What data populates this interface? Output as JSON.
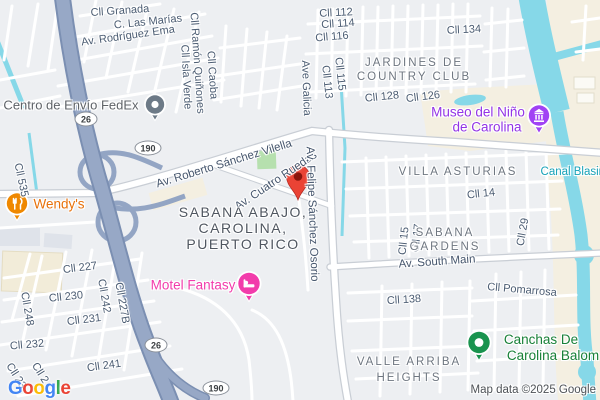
{
  "labels": {
    "streets": {
      "granada": "Cll Granada",
      "las_marias": "C. Las Marías",
      "rodriguez_ema": "Av. Rodríguez Ema",
      "ramon_quinones": "Cll Ramón Quiñones",
      "isla_verde": "Cll Isla Verde",
      "caoba": "Cll Caoba",
      "cll112": "Cll 112",
      "cll114": "Cll 114",
      "cll116": "Cll 116",
      "cll134": "Cll 134",
      "ave_galicia": "Ave Galicia",
      "cll115": "Cll 115",
      "cll113": "Cll 113",
      "cll128": "Cll 128",
      "cll126": "Cll 126",
      "vilella": "Av. Roberto Sánchez Vilella",
      "cuatro_ruedas": "Av. Cuatro Ruedas",
      "osorio": "Av. Felipe Sánchez Osorio",
      "cll535": "Cll 535",
      "cll14": "Cll 14",
      "cll15": "Cll 15",
      "cll17": "Cll 17",
      "cll29": "Cll 29",
      "south_main": "Av. South Main",
      "cll227": "Cll 227",
      "cll230": "Cll 230",
      "cll248": "Cll 248",
      "cll242": "Cll 242",
      "cll227b": "Cll 227B",
      "cll231": "Cll 231",
      "cll232": "Cll 232",
      "cll241": "Cll 241",
      "cll138": "Cll 138",
      "pomarrosa": "Cll Pomarrosa",
      "cll23_a": "Cll 23",
      "cll23_b": "Cll 2"
    },
    "areas": {
      "jardines_1": "JARDINES DE",
      "jardines_2": "COUNTRY CLUB",
      "villa_asturias": "VILLA ASTURIAS",
      "sabana_gardens_1": "SABANA",
      "sabana_gardens_2": "GARDENS",
      "sabana_abajo_1": "SABANA ABAJO,",
      "sabana_abajo_2": "CAROLINA,",
      "sabana_abajo_3": "PUERTO RICO",
      "valle_arriba_1": "VALLE ARRIBA",
      "valle_arriba_2": "HEIGHTS"
    },
    "water": {
      "canal_blasina": "Canal Blasina"
    }
  },
  "pois": {
    "fedex": {
      "label": "Centro de Envío FedEx",
      "icon": "generic-poi-pin",
      "color": "#6d7a87"
    },
    "wendys": {
      "label": "Wendy's",
      "icon": "restaurant-pin",
      "color": "#ef8800"
    },
    "motel": {
      "label": "Motel Fantasy",
      "icon": "hotel-bed-pin",
      "color": "#f23cab"
    },
    "museo": {
      "line1": "Museo del Niño",
      "line2": "de Carolina",
      "icon": "museum-pin",
      "color": "#a142f4"
    },
    "canchas": {
      "line1": "Canchas De",
      "line2": "Carolina Balom",
      "icon": "sports-field-pin",
      "color": "#19934e"
    }
  },
  "badges": {
    "pr26": "26",
    "pr190": "190"
  },
  "marker": {
    "type": "destination-pin",
    "color": "#EA4335"
  },
  "footer": {
    "attribution": "Map data ©2025 Google",
    "logo": [
      {
        "ch": "G",
        "color": "#4285F4"
      },
      {
        "ch": "o",
        "color": "#EA4335"
      },
      {
        "ch": "o",
        "color": "#FBBC05"
      },
      {
        "ch": "g",
        "color": "#4285F4"
      },
      {
        "ch": "l",
        "color": "#34A853"
      },
      {
        "ch": "e",
        "color": "#EA4335"
      }
    ]
  },
  "colors": {
    "land": "#edeff2",
    "poi_area": "#f4efe1",
    "water": "#86d8e8",
    "highway_fill": "#97a8c6",
    "highway_casing": "#7b8fb2",
    "park_green": "#b6e0ae"
  }
}
